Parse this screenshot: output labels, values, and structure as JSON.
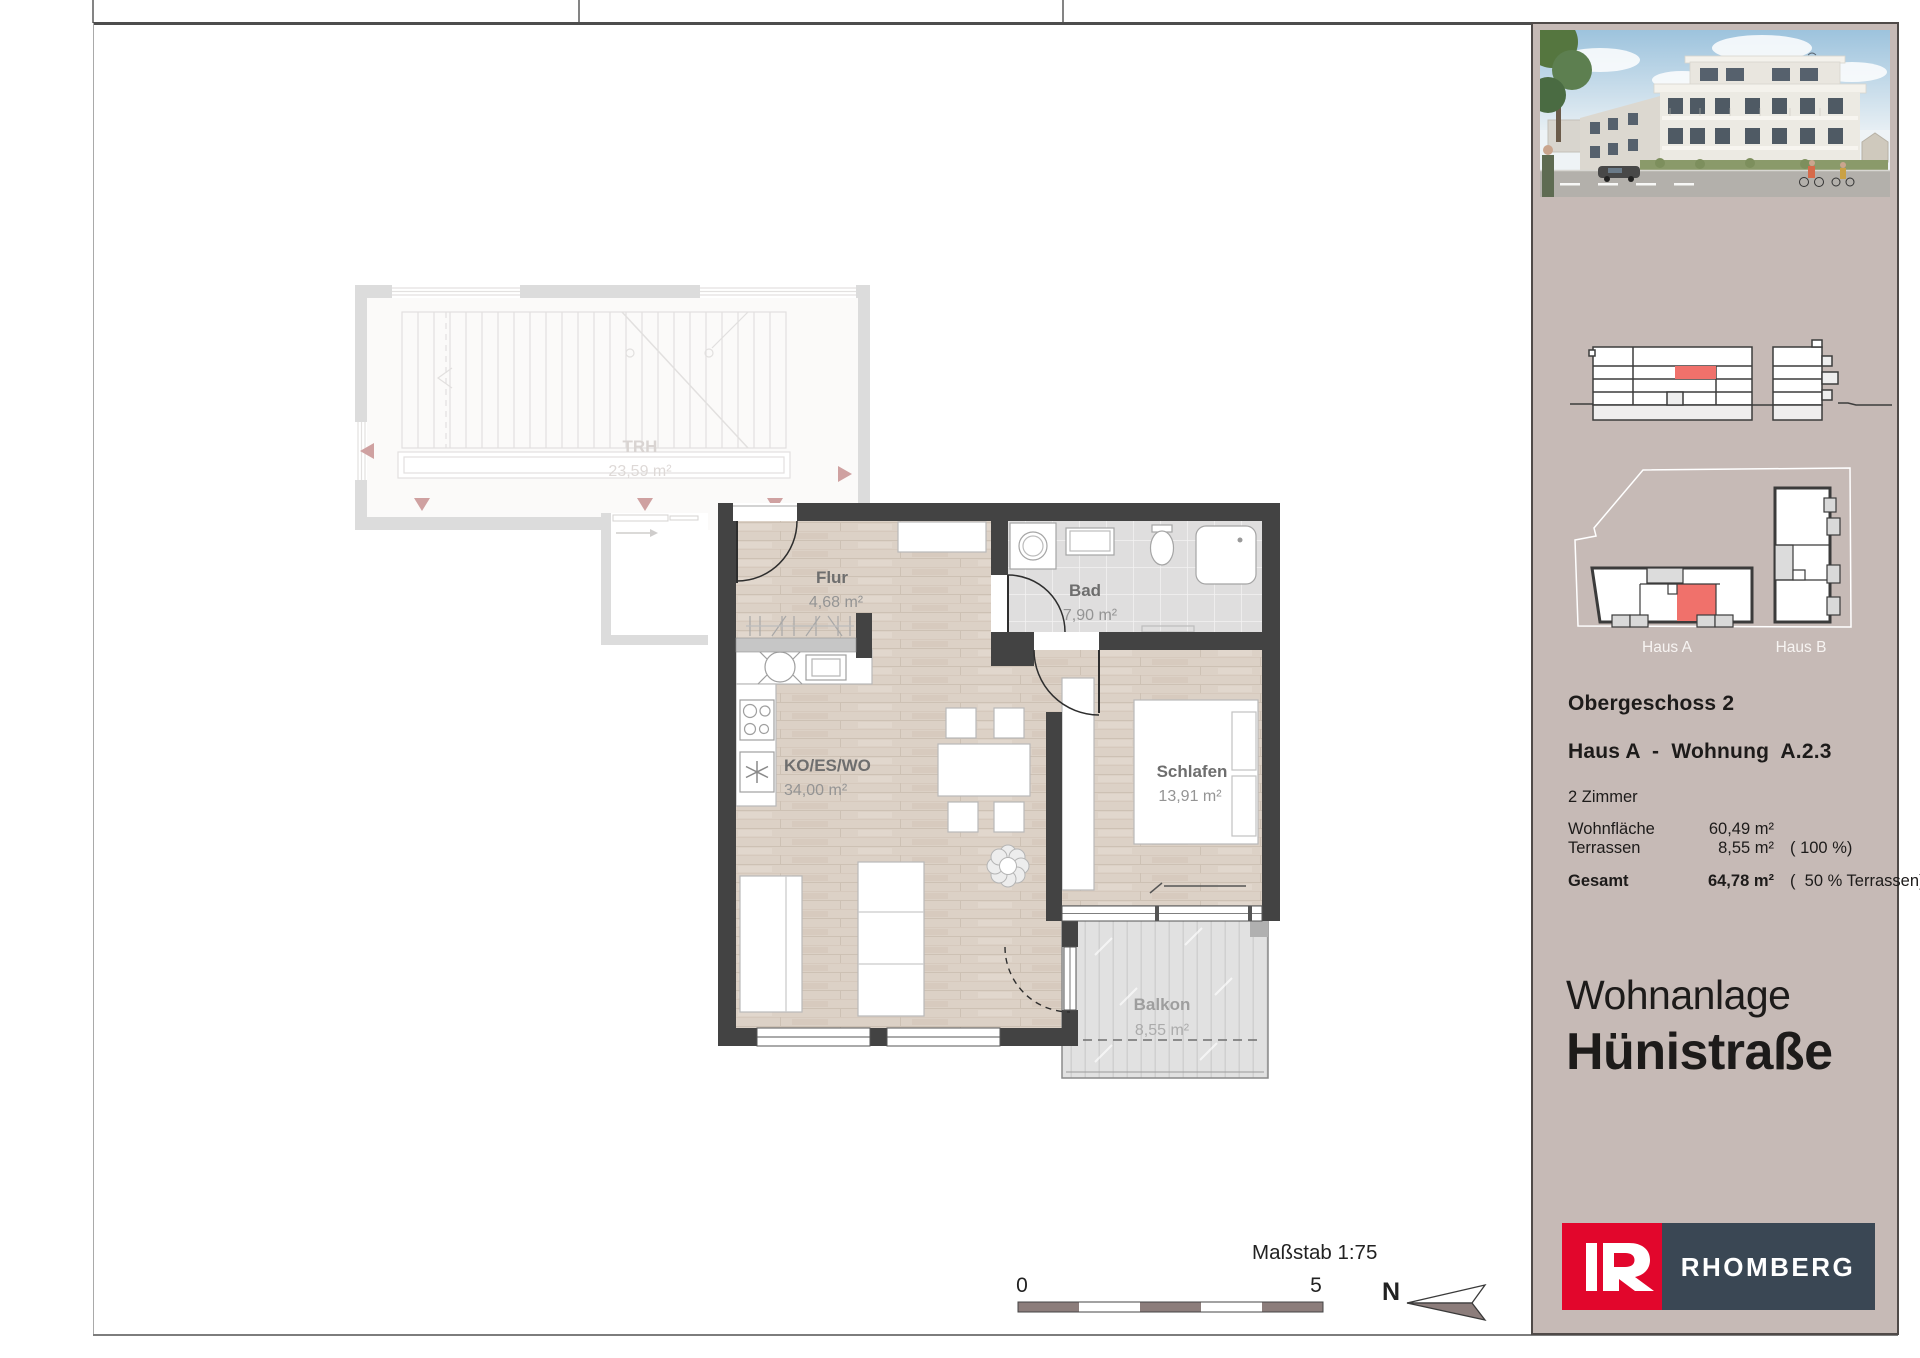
{
  "sidebar": {
    "floor": "Obergeschoss 2",
    "unit": "Haus A  -  Wohnung  A.2.3",
    "rooms_count": "2 Zimmer",
    "area_rows": {
      "wohnflaeche_label": "Wohnfläche",
      "wohnflaeche_value": "60,49 m²",
      "terrassen_label": "Terrassen",
      "terrassen_value": "8,55 m²",
      "terrassen_note": "( 100 %)",
      "gesamt_label": "Gesamt",
      "gesamt_value": "64,78 m²",
      "gesamt_note": "(  50 % Terrassen)"
    },
    "project_line1": "Wohnanlage",
    "project_line2": "Hünistraße",
    "site_plan": {
      "haus_a": "Haus A",
      "haus_b": "Haus B"
    },
    "logo": {
      "text": "RHOMBERG"
    },
    "hero_image": "building-rendering"
  },
  "plan": {
    "trh": {
      "name": "TRH",
      "area": "23,59 m²"
    },
    "flur": {
      "name": "Flur",
      "area": "4,68 m²"
    },
    "bad": {
      "name": "Bad",
      "area": "7,90 m²"
    },
    "wohnen": {
      "name": "KO/ES/WO",
      "area": "34,00 m²"
    },
    "schlafen": {
      "name": "Schlafen",
      "area": "13,91 m²"
    },
    "balkon": {
      "name": "Balkon",
      "area": "8,55 m²"
    }
  },
  "footer": {
    "scale_label": "Maßstab 1:75",
    "scale_min": "0",
    "scale_max": "5",
    "north": "N"
  },
  "colors": {
    "sidebar_bg": "#c6bab6",
    "accent_red": "#f0716b",
    "logo_red": "#e2062c",
    "logo_slate": "#3a4754",
    "wall_dark": "#434343",
    "scale_dark": "#8c7d7b"
  }
}
